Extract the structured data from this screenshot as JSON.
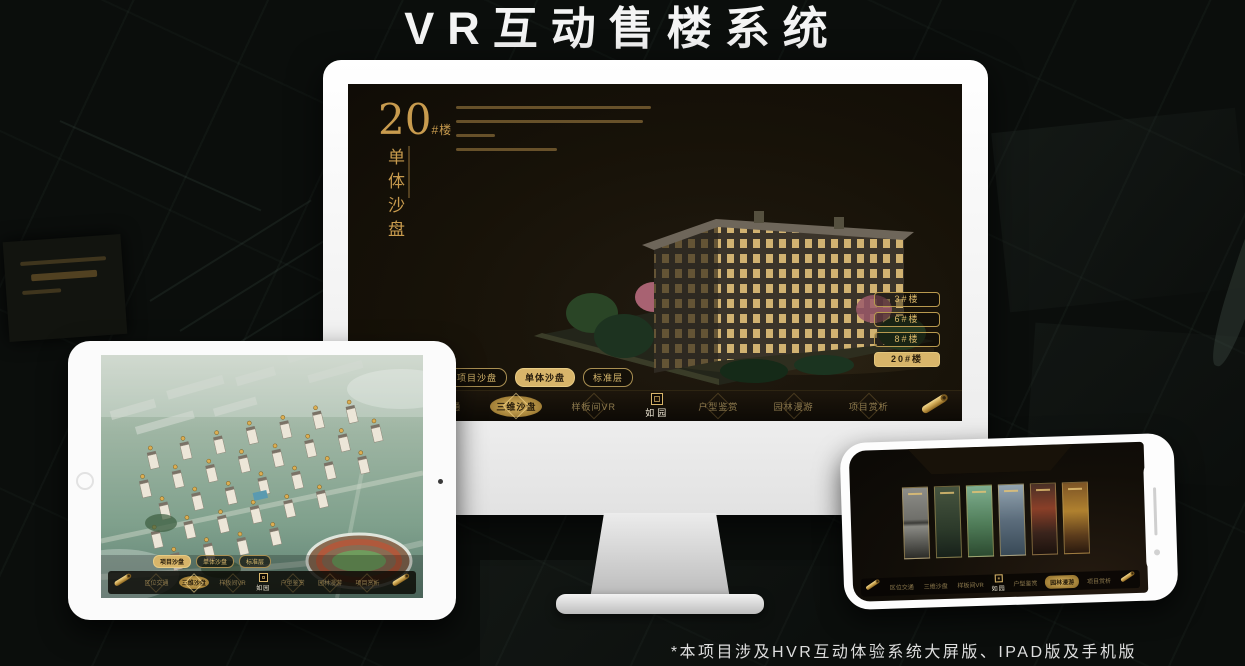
{
  "page": {
    "title": "VR互动售楼系统",
    "footnote": "*本项目涉及HVR互动体验系统大屏版、IPAD版及手机版"
  },
  "colors": {
    "gold_accent": "#d8b56a",
    "gold_text": "#c89b4e",
    "screen_background": "#171208",
    "device_frame": "#fdfdfd"
  },
  "monitor": {
    "building_label": {
      "number": "20",
      "unit": "#楼",
      "subtitle": "单体沙盘"
    },
    "floor_buttons": [
      {
        "label": "3#楼"
      },
      {
        "label": "6#楼"
      },
      {
        "label": "8#楼"
      },
      {
        "label": "20#楼",
        "active": true
      }
    ],
    "sub_tabs": [
      {
        "label": "项目沙盘"
      },
      {
        "label": "单体沙盘",
        "active": true
      },
      {
        "label": "标准层"
      }
    ]
  },
  "nav": {
    "logo": "如园",
    "items": [
      "区位交通",
      "三维沙盘",
      "样板间VR",
      "户型鉴赏",
      "园林漫游",
      "项目赏析"
    ]
  },
  "tablet": {
    "sub_tabs": [
      {
        "label": "项目沙盘",
        "active": true
      },
      {
        "label": "单体沙盘"
      },
      {
        "label": "标准层"
      }
    ]
  }
}
